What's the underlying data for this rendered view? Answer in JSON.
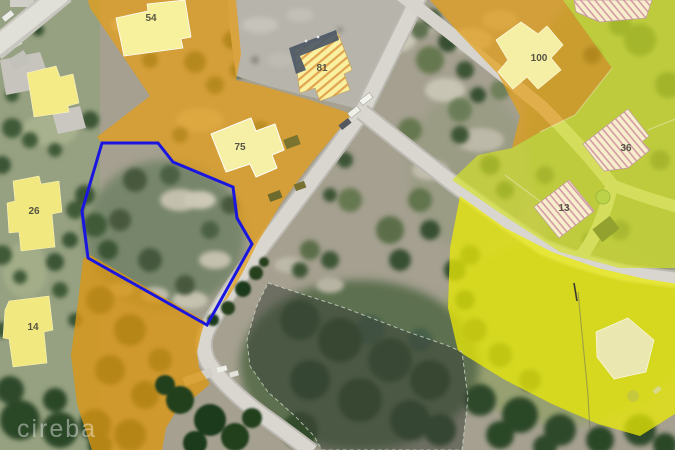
{
  "image_type": "aerial-parcel-map-photo",
  "watermark": {
    "text": "cireba"
  },
  "parcels": {
    "p54": {
      "label": "54"
    },
    "p81": {
      "label": "81"
    },
    "p100": {
      "label": "100"
    },
    "p75": {
      "label": "75"
    },
    "p26": {
      "label": "26"
    },
    "p14": {
      "label": "14"
    },
    "p36": {
      "label": "36"
    },
    "p13": {
      "label": "13"
    }
  },
  "colors": {
    "subject_boundary_blue": "#1a16e0",
    "parcel_overlay_orange": "#e69e16",
    "parcel_overlay_chartreuse": "#d4e226",
    "parcel_overlay_yellow": "#ebeb06",
    "parcel_overlay_gray": "#3c443a",
    "building_solid_yellow": "#f2e883",
    "building_pale_yellow": "#f5efa3"
  }
}
